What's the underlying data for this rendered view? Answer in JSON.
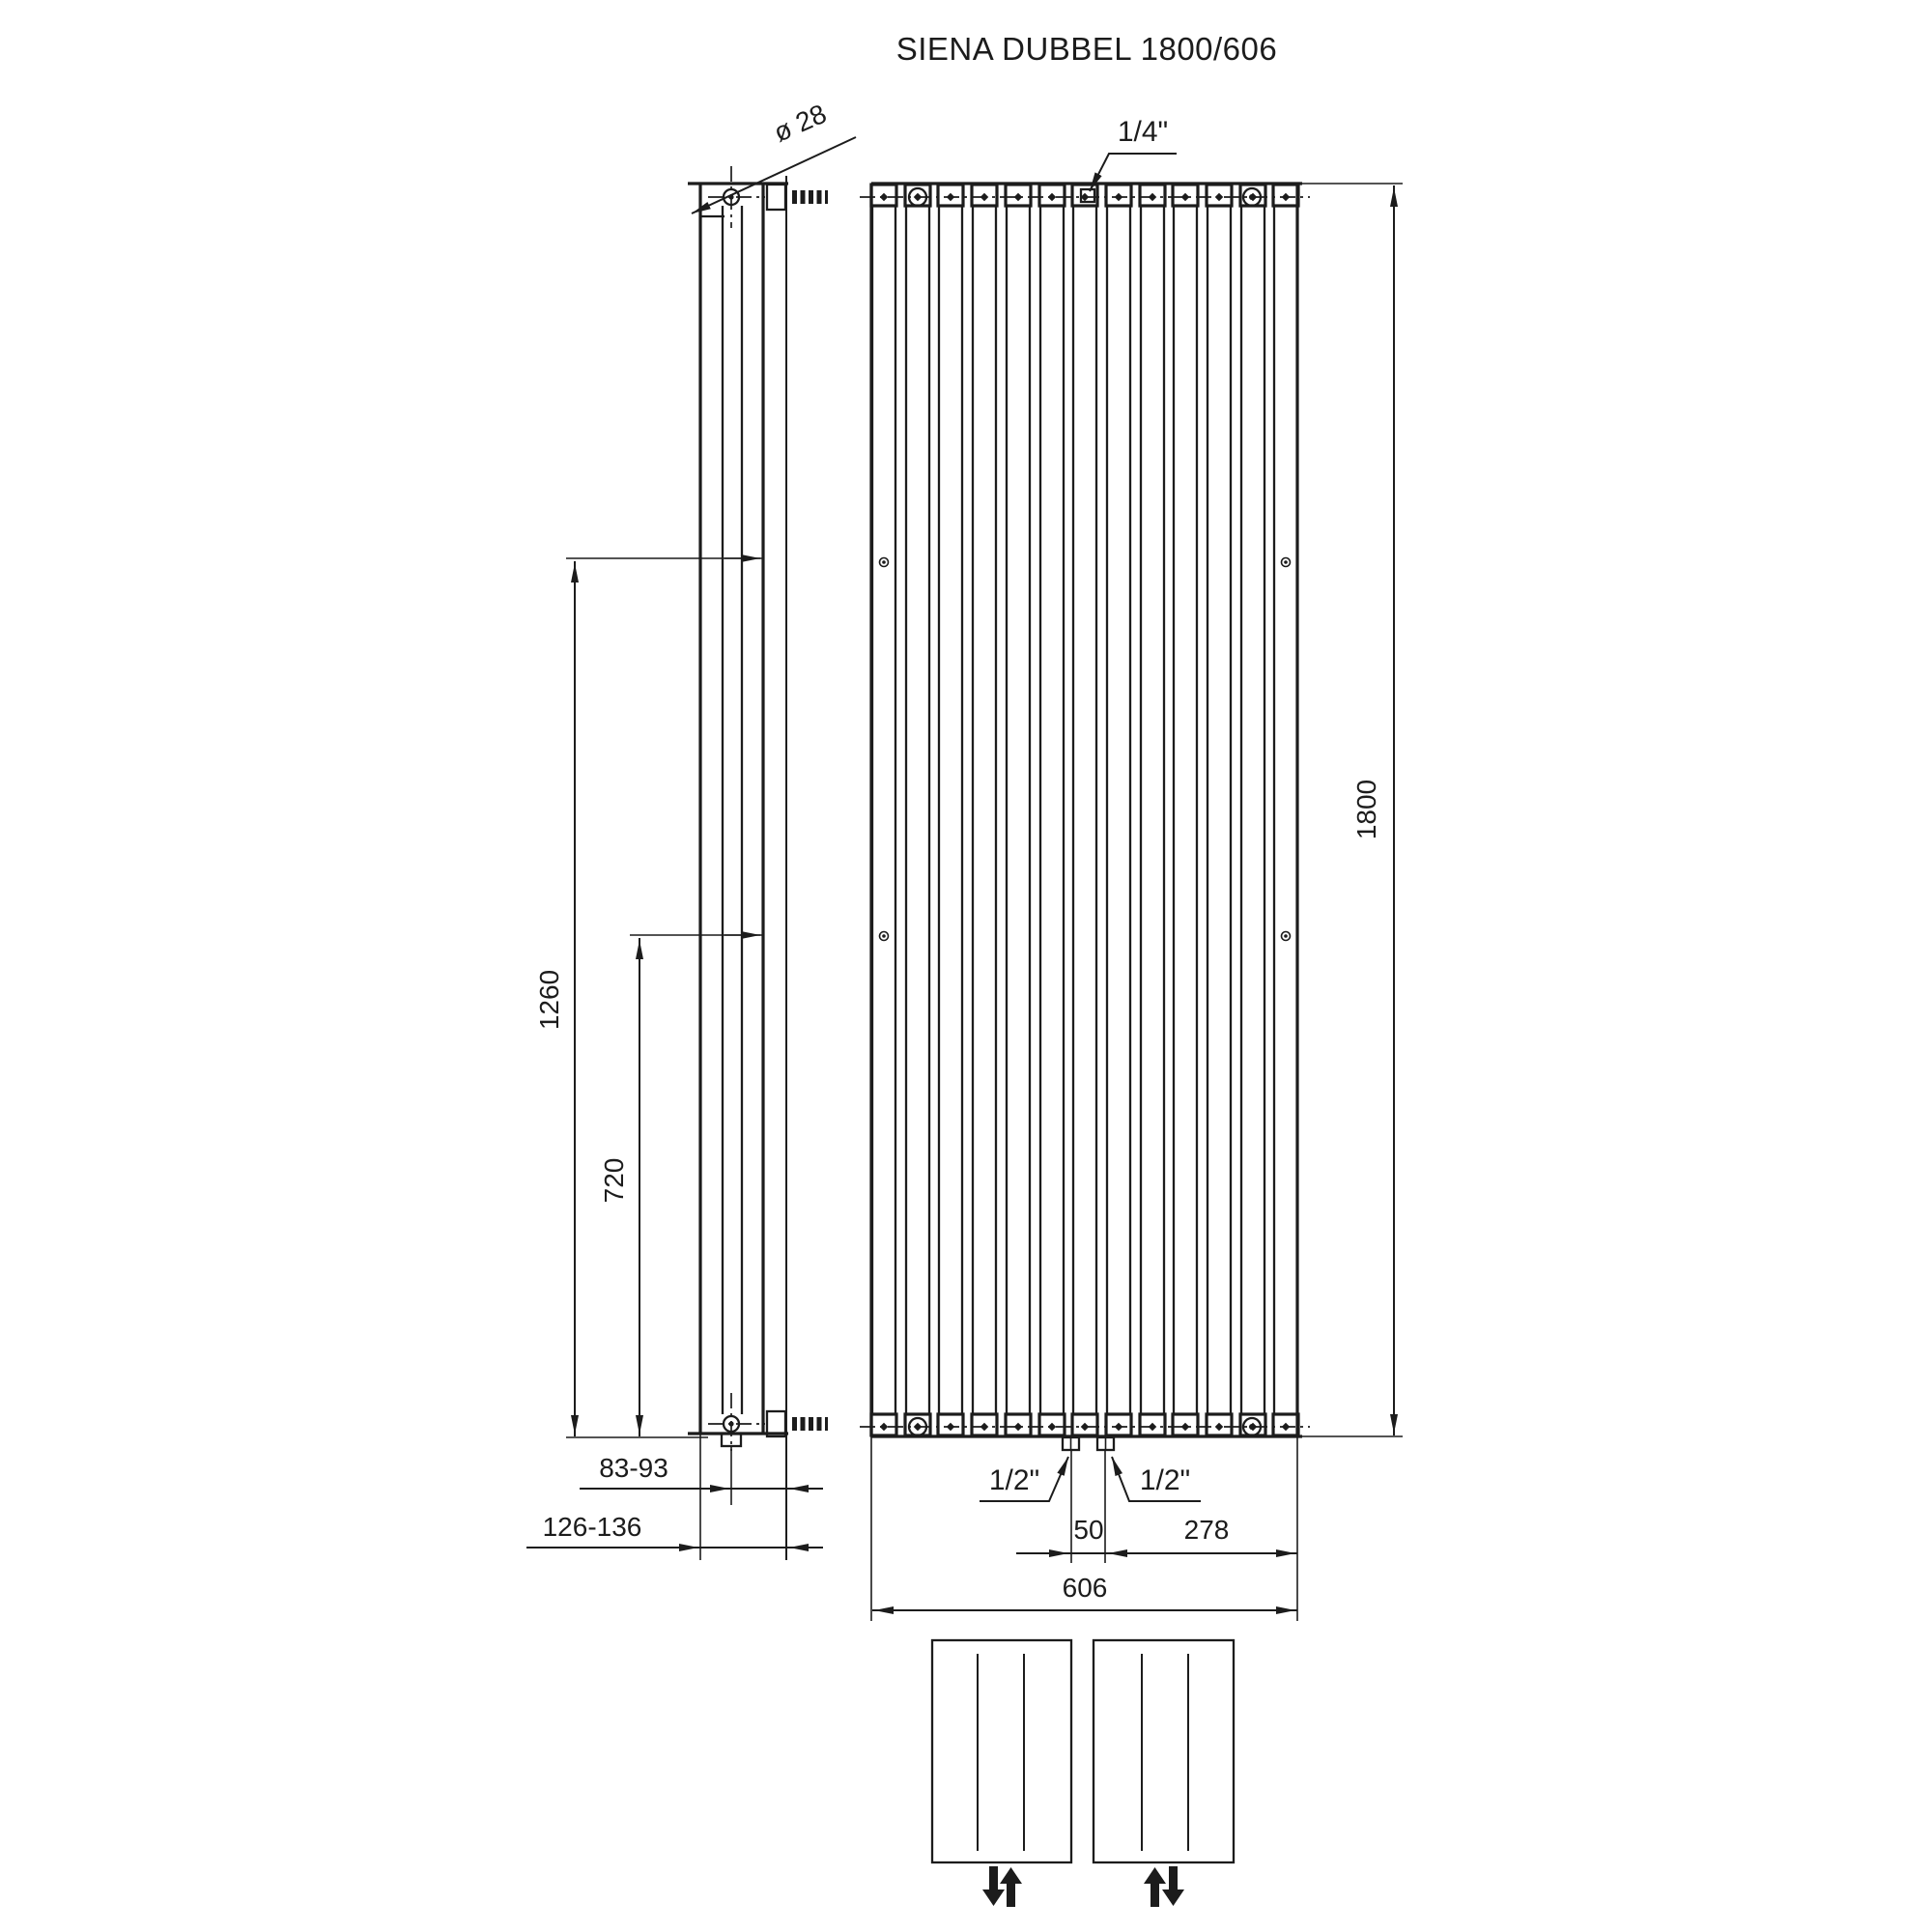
{
  "title": "SIENA DUBBEL 1800/606",
  "side_view": {
    "diameter_label": "ø 28"
  },
  "front_view": {
    "tube_count": 13,
    "top_connection_label": "1/4\"",
    "bottom_connection_left_label": "1/2\"",
    "bottom_connection_right_label": "1/2\""
  },
  "dimensions": {
    "height": "1800",
    "width": "606",
    "upper_bracket_height": "1260",
    "lower_bracket_height": "720",
    "wall_to_axis": "83-93",
    "wall_to_front": "126-136",
    "valve_spacing": "50",
    "valve_to_edge": "278"
  },
  "flow_schematics": {
    "left_box_arrows": "down-up",
    "right_box_arrows": "up-down"
  },
  "colors": {
    "line": "#1c1c1c",
    "background": "#ffffff"
  }
}
